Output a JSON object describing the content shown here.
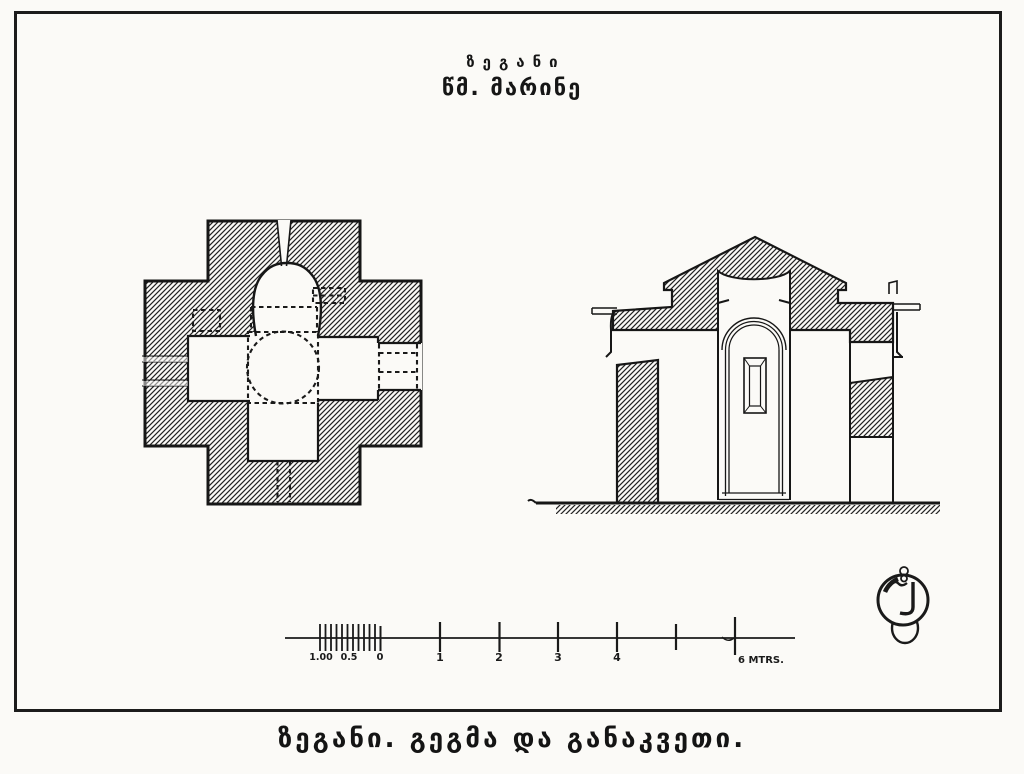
{
  "colors": {
    "paper": "#fbfaf7",
    "ink": "#1a1a1a"
  },
  "header": {
    "title": "ზეგანი",
    "subtitle": "წმ. მარინე"
  },
  "caption": "ზეგანი. გეგმა და განაკვეთი.",
  "scale_bar": {
    "minor_labels": [
      "1.00",
      "0.5",
      "0"
    ],
    "major_labels": [
      "1",
      "2",
      "3",
      "4"
    ],
    "end_label": "6 MTRS."
  }
}
